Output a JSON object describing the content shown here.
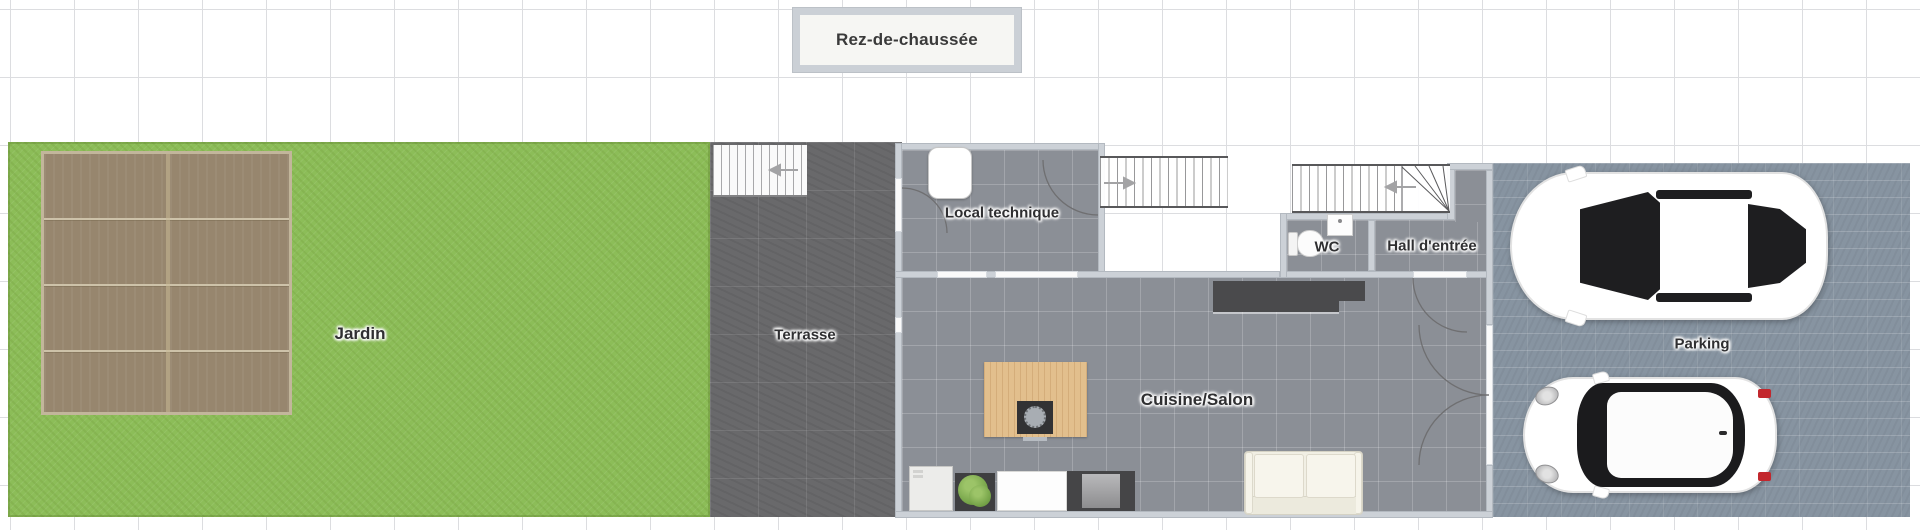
{
  "floor_label": {
    "title": "Rez-de-chaussée"
  },
  "rooms": {
    "jardin": {
      "label": "Jardin"
    },
    "terrasse": {
      "label": "Terrasse"
    },
    "local_technique": {
      "label": "Local technique"
    },
    "wc": {
      "label": "WC"
    },
    "hall": {
      "label": "Hall d'entrée"
    },
    "cuisine_salon": {
      "label": "Cuisine/Salon"
    },
    "parking": {
      "label": "Parking"
    }
  },
  "furniture": [
    "wood-deck",
    "terrace-staircase",
    "upper-staircase",
    "winder-staircase",
    "water-heater",
    "toilet",
    "washbasin",
    "kitchen-counter",
    "kitchen-island",
    "island-sink",
    "fridge",
    "plant",
    "sink-counter",
    "stove",
    "sofa",
    "sedan-car",
    "hatchback-car"
  ],
  "colors": {
    "grass": "#8cbd58",
    "deck_wood": "#97866e",
    "terrace_tile": "#69696b",
    "floor_tile": "#8b8f96",
    "wall": "#ccd1d7",
    "paver": "#8794a1",
    "counter_dark": "#4a4a4c",
    "island_wood": "#e2bf8d",
    "label_text": "#2f2f31"
  }
}
